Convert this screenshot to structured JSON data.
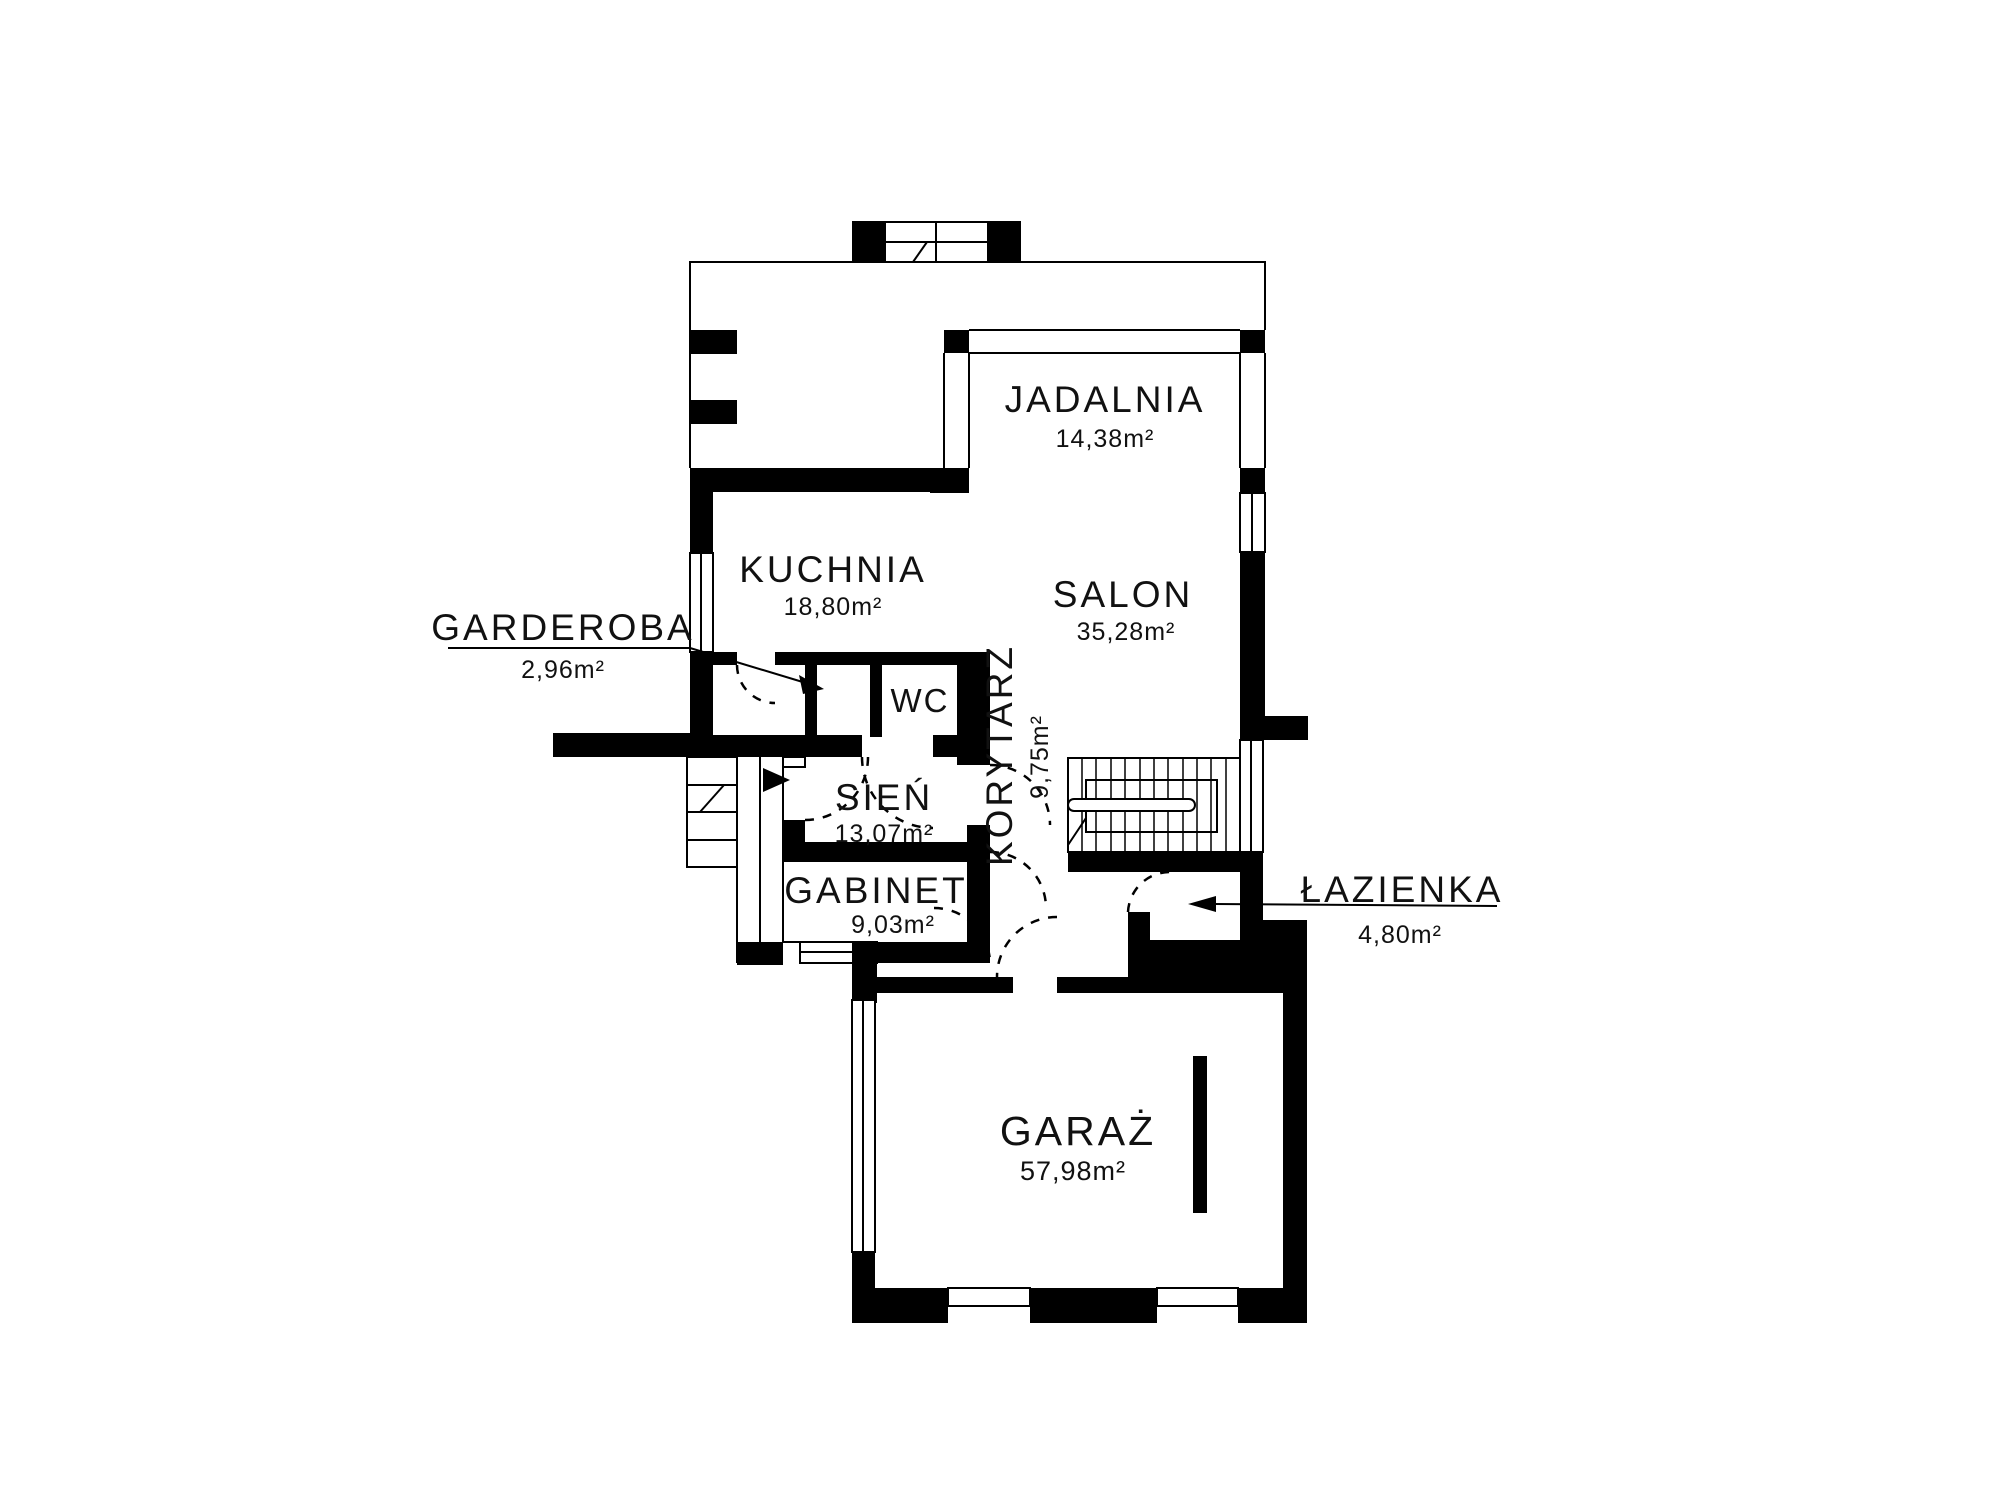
{
  "plan": {
    "colors": {
      "wall": "#000000",
      "background": "#ffffff",
      "text": "#111111"
    },
    "rooms": [
      {
        "id": "jadalnia",
        "name": "JADALNIA",
        "area": "14,38m²"
      },
      {
        "id": "kuchnia",
        "name": "KUCHNIA",
        "area": "18,80m²"
      },
      {
        "id": "salon",
        "name": "SALON",
        "area": "35,28m²"
      },
      {
        "id": "garderoba",
        "name": "GARDEROBA",
        "area": "2,96m²"
      },
      {
        "id": "wc",
        "name": "WC",
        "area": ""
      },
      {
        "id": "korytarz",
        "name": "KORYTARZ",
        "area": "9,75m²"
      },
      {
        "id": "sien",
        "name": "SIEŃ",
        "area": "13,07m²"
      },
      {
        "id": "gabinet",
        "name": "GABINET",
        "area": "9,03m²"
      },
      {
        "id": "lazienka",
        "name": "ŁAZIENKA",
        "area": "4,80m²"
      },
      {
        "id": "garaz",
        "name": "GARAŻ",
        "area": "57,98m²"
      }
    ]
  }
}
